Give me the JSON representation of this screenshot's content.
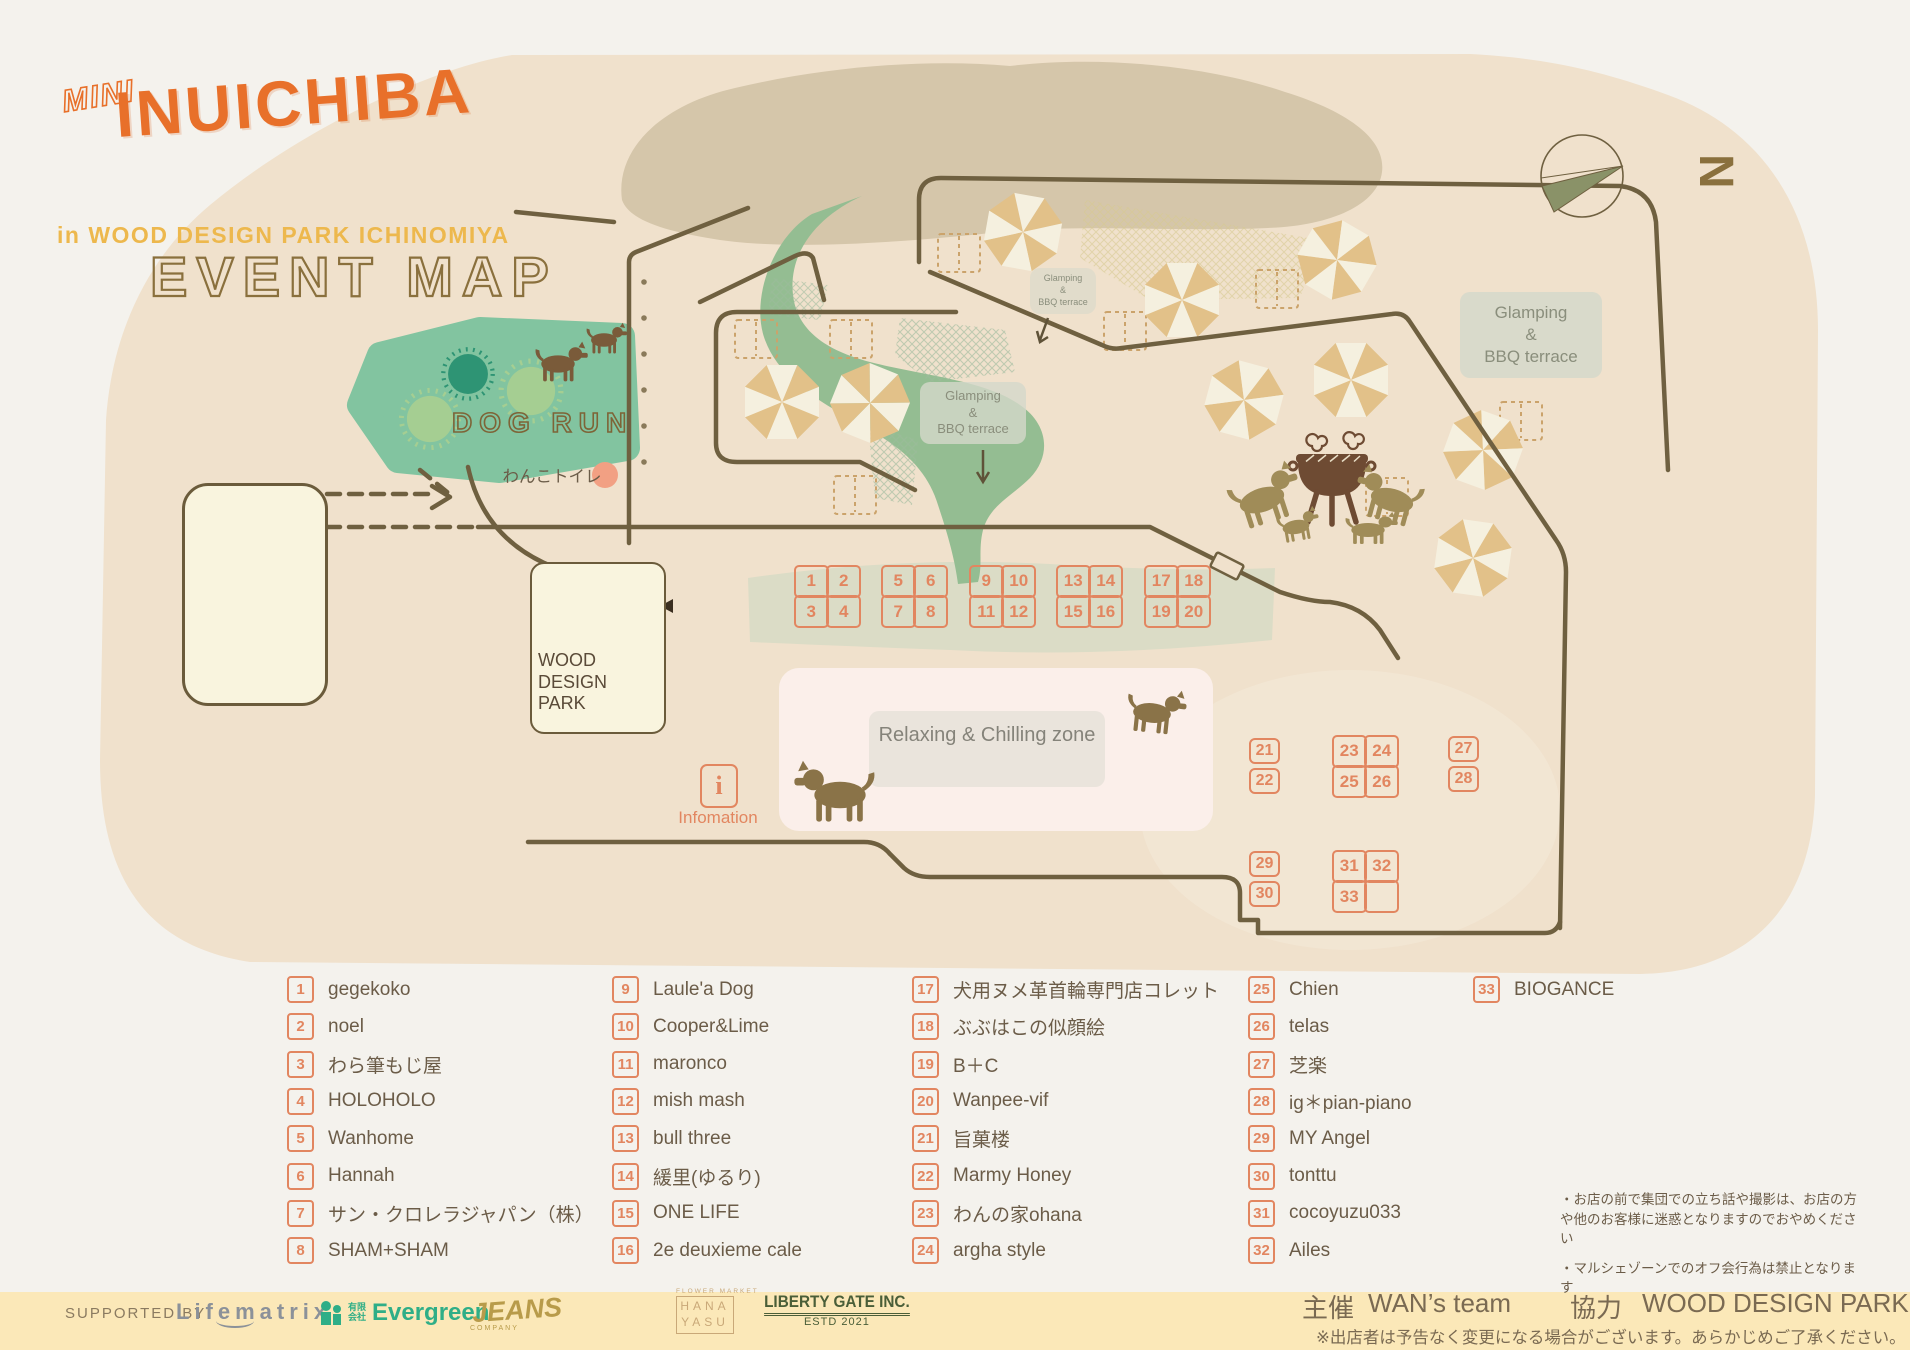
{
  "title": {
    "mini": "MINI",
    "main": "INUICHIBA",
    "subtitle": "in WOOD DESIGN PARK ICHINOMIYA",
    "map_label": "EVENT MAP"
  },
  "compass": {
    "north": "N"
  },
  "map_labels": {
    "dog_run": "DOG RUN",
    "dog_toilet": "わんこトイレ",
    "food_line1": "FOOD",
    "food_line2": "AREA",
    "park_lines": [
      "WOOD",
      "DESIGN",
      "PARK"
    ],
    "relaxing_zone": "Relaxing & Chilling zone",
    "information": "Infomation",
    "glamping": {
      "line1": "Glamping",
      "line2": "&",
      "line3": "BBQ terrace"
    }
  },
  "booths": {
    "grids": [
      {
        "id": "g1",
        "cols": 2,
        "cells": [
          "1",
          "2",
          "3",
          "4"
        ]
      },
      {
        "id": "g2",
        "cols": 2,
        "cells": [
          "5",
          "6",
          "7",
          "8"
        ]
      },
      {
        "id": "g3",
        "cols": 2,
        "cells": [
          "9",
          "10",
          "11",
          "12"
        ]
      },
      {
        "id": "g4",
        "cols": 2,
        "cells": [
          "13",
          "14",
          "15",
          "16"
        ]
      },
      {
        "id": "g5",
        "cols": 2,
        "cells": [
          "17",
          "18",
          "19",
          "20"
        ]
      },
      {
        "id": "p21",
        "cols": 1,
        "cells": [
          "21",
          "22"
        ]
      },
      {
        "id": "g23",
        "cols": 2,
        "cells": [
          "23",
          "24",
          "25",
          "26"
        ]
      },
      {
        "id": "p27",
        "cols": 1,
        "cells": [
          "27",
          "28"
        ]
      },
      {
        "id": "p29",
        "cols": 1,
        "cells": [
          "29",
          "30"
        ]
      },
      {
        "id": "g31",
        "cols": 2,
        "cells": [
          "31",
          "32",
          "33",
          ""
        ]
      }
    ]
  },
  "legend": {
    "items": [
      {
        "num": "1",
        "name": "gegekoko"
      },
      {
        "num": "2",
        "name": "noel"
      },
      {
        "num": "3",
        "name": "わら筆もじ屋"
      },
      {
        "num": "4",
        "name": "HOLOHOLO"
      },
      {
        "num": "5",
        "name": "Wanhome"
      },
      {
        "num": "6",
        "name": "Hannah"
      },
      {
        "num": "7",
        "name": "サン・クロレラジャパン（株）"
      },
      {
        "num": "8",
        "name": "SHAM+SHAM"
      },
      {
        "num": "9",
        "name": "Laule'a Dog"
      },
      {
        "num": "10",
        "name": "Cooper&Lime"
      },
      {
        "num": "11",
        "name": "maronco"
      },
      {
        "num": "12",
        "name": "mish mash"
      },
      {
        "num": "13",
        "name": "bull three"
      },
      {
        "num": "14",
        "name": "緩里(ゆるり)"
      },
      {
        "num": "15",
        "name": "ONE LIFE"
      },
      {
        "num": "16",
        "name": "2e deuxieme cale"
      },
      {
        "num": "17",
        "name": "犬用ヌメ革首輪専門店コレット"
      },
      {
        "num": "18",
        "name": "ぶぶはこの似顔絵"
      },
      {
        "num": "19",
        "name": "B＋C"
      },
      {
        "num": "20",
        "name": "Wanpee-vif"
      },
      {
        "num": "21",
        "name": "旨菓楼"
      },
      {
        "num": "22",
        "name": "Marmy Honey"
      },
      {
        "num": "23",
        "name": "わんの家ohana"
      },
      {
        "num": "24",
        "name": "argha style"
      },
      {
        "num": "25",
        "name": "Chien"
      },
      {
        "num": "26",
        "name": "telas"
      },
      {
        "num": "27",
        "name": "芝楽"
      },
      {
        "num": "28",
        "name": "ig＊pian-piano"
      },
      {
        "num": "29",
        "name": "MY Angel"
      },
      {
        "num": "30",
        "name": "tonttu"
      },
      {
        "num": "31",
        "name": "cocoyuzu033"
      },
      {
        "num": "32",
        "name": "Ailes"
      },
      {
        "num": "33",
        "name": "BIOGANCE"
      }
    ]
  },
  "notes": [
    "・お店の前で集団での立ち話や撮影は、お店の方や他のお客様に迷惑となりますのでおやめください",
    "・マルシェゾーンでのオフ会行為は禁止となります"
  ],
  "footer": {
    "supported_by": "SUPPORTED  BY",
    "lifematrix": "Lifematrix",
    "evergreen_prefix": "有限会社",
    "evergreen": "Evergreen",
    "jeans": "JEANS",
    "jeans_sub": "COMPANY",
    "hana_top": "FLOWER MARKET",
    "hana_line1": "HANA",
    "hana_line2": "YASU",
    "liberty": "LIBERTY GATE INC.",
    "liberty_sub": "ESTD 2021",
    "organizer_label": "主催",
    "organizer": "WAN’s team",
    "cooperation_label": "協力",
    "cooperation": "WOOD DESIGN PARK",
    "disclaimer": "※出店者は予告なく変更になる場合がございます。あらかじめご了承ください。"
  },
  "colors": {
    "accent_orange": "#E28660",
    "road_brown": "#6F6040",
    "dogrun_green": "#82C4A0",
    "map_beige": "#F0E1CC",
    "footer_yellow": "#FBE8B8"
  }
}
